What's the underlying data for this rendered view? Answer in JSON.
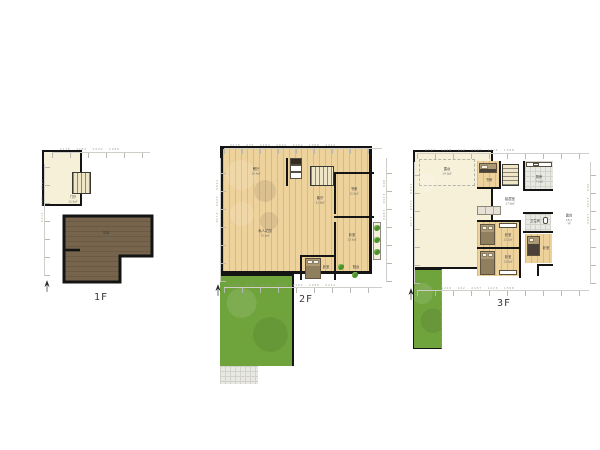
{
  "floors": [
    {
      "label": "1F",
      "rooms": [
        {
          "name": "门厅",
          "area": "11.9㎡"
        },
        {
          "name": "车库",
          "area": "40.2㎡"
        }
      ],
      "dims": {
        "top": "2775 · 1284 · 2940 · 1388",
        "left": "1590 · 3260 · 1140"
      }
    },
    {
      "label": "2F",
      "rooms": [
        {
          "name": "餐厅",
          "area": "19.4㎡"
        },
        {
          "name": "私人花园",
          "area": "72.6㎡"
        },
        {
          "name": "客厅",
          "area": "31.8㎡"
        },
        {
          "name": "书房",
          "area": "11.5㎡"
        },
        {
          "name": "卧室",
          "area": "13.8㎡"
        },
        {
          "name": "卧室",
          "area": "9.6㎡"
        },
        {
          "name": "阳台",
          "area": "4.2㎡"
        }
      ],
      "dims": {
        "top": "3475 · 275 · 1284 · 2940 · 2162 · 1388 · 2412",
        "bottom": "3475 · 275 · 1284 · 2940 · 2162 · 1388 · 2412",
        "left": "1590 · 3260 · 2140",
        "right": "900 · 2460 · 1980"
      }
    },
    {
      "label": "3F",
      "rooms": [
        {
          "name": "露台",
          "area": "14.3㎡"
        },
        {
          "name": "书房",
          "area": "6.8㎡"
        },
        {
          "name": "厨房",
          "area": "7.2㎡"
        },
        {
          "name": "起居室",
          "area": "17.6㎡"
        },
        {
          "name": "卧室",
          "area": "12.2㎡"
        },
        {
          "name": "卧室",
          "area": "13.5㎡"
        },
        {
          "name": "卫生间",
          "area": "4.6㎡"
        },
        {
          "name": "卧室",
          "area": "8.9㎡"
        },
        {
          "name": "露台",
          "area": "15.7㎡"
        }
      ],
      "dims": {
        "top": "3737 · 1226 · 302 · 2467 · 1226 · 1598",
        "bottom": "3737 · 1226 · 302 · 2467 · 1226 · 1598",
        "left": "1590 · 3260 · 2140",
        "right": "900 · 2460 · 1980"
      }
    }
  ],
  "colors": {
    "wall": "#141414",
    "wood_floor": "#eed29c",
    "cream_floor": "#f7f0d8",
    "garden_green": "#6fa33c",
    "garage_brown": "#76654c",
    "tile_gray": "#e9e9e4"
  }
}
